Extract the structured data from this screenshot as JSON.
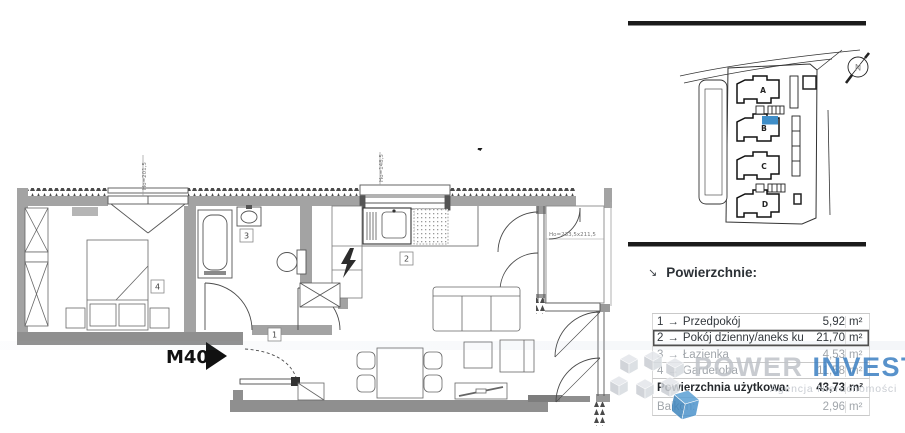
{
  "plan": {
    "unit_label": "M40",
    "rooms": [
      "1",
      "2",
      "3",
      "4"
    ],
    "compass_letter": "N",
    "dims": {
      "bedroom_window": "Ho=201,5",
      "kitchen_window": "Ho=148,5",
      "balcony": "Ho=233,5x211,5"
    }
  },
  "site_plan": {
    "buildings": [
      "A",
      "B",
      "C",
      "D"
    ],
    "compass_letter": "N",
    "highlight_color": "#3f8ec8"
  },
  "areas": {
    "header": {
      "arrow": "↘",
      "title": "Powierzchnie:"
    },
    "arrow": "→",
    "unit": "m²",
    "rows": [
      {
        "num": "1",
        "name": "Przedpokój",
        "value": "5,92"
      },
      {
        "num": "2",
        "name": "Pokój dzienny/aneks kuchenny",
        "value": "21,70"
      },
      {
        "num": "3",
        "name": "Łazienka",
        "value": "4,53"
      },
      {
        "num": "4",
        "name": "Garderoba",
        "value": "11,58"
      }
    ],
    "total": {
      "label": "Powierzchnia użytkowa:",
      "value": "43,73"
    },
    "balcony": {
      "label": "Balkon:",
      "value": "2,96"
    }
  },
  "watermark": {
    "brand_1": "POWER",
    "brand_2": "INVEST",
    "tagline": "Agencja Nieruchomości",
    "brand_2_color": "#3b80c2"
  }
}
